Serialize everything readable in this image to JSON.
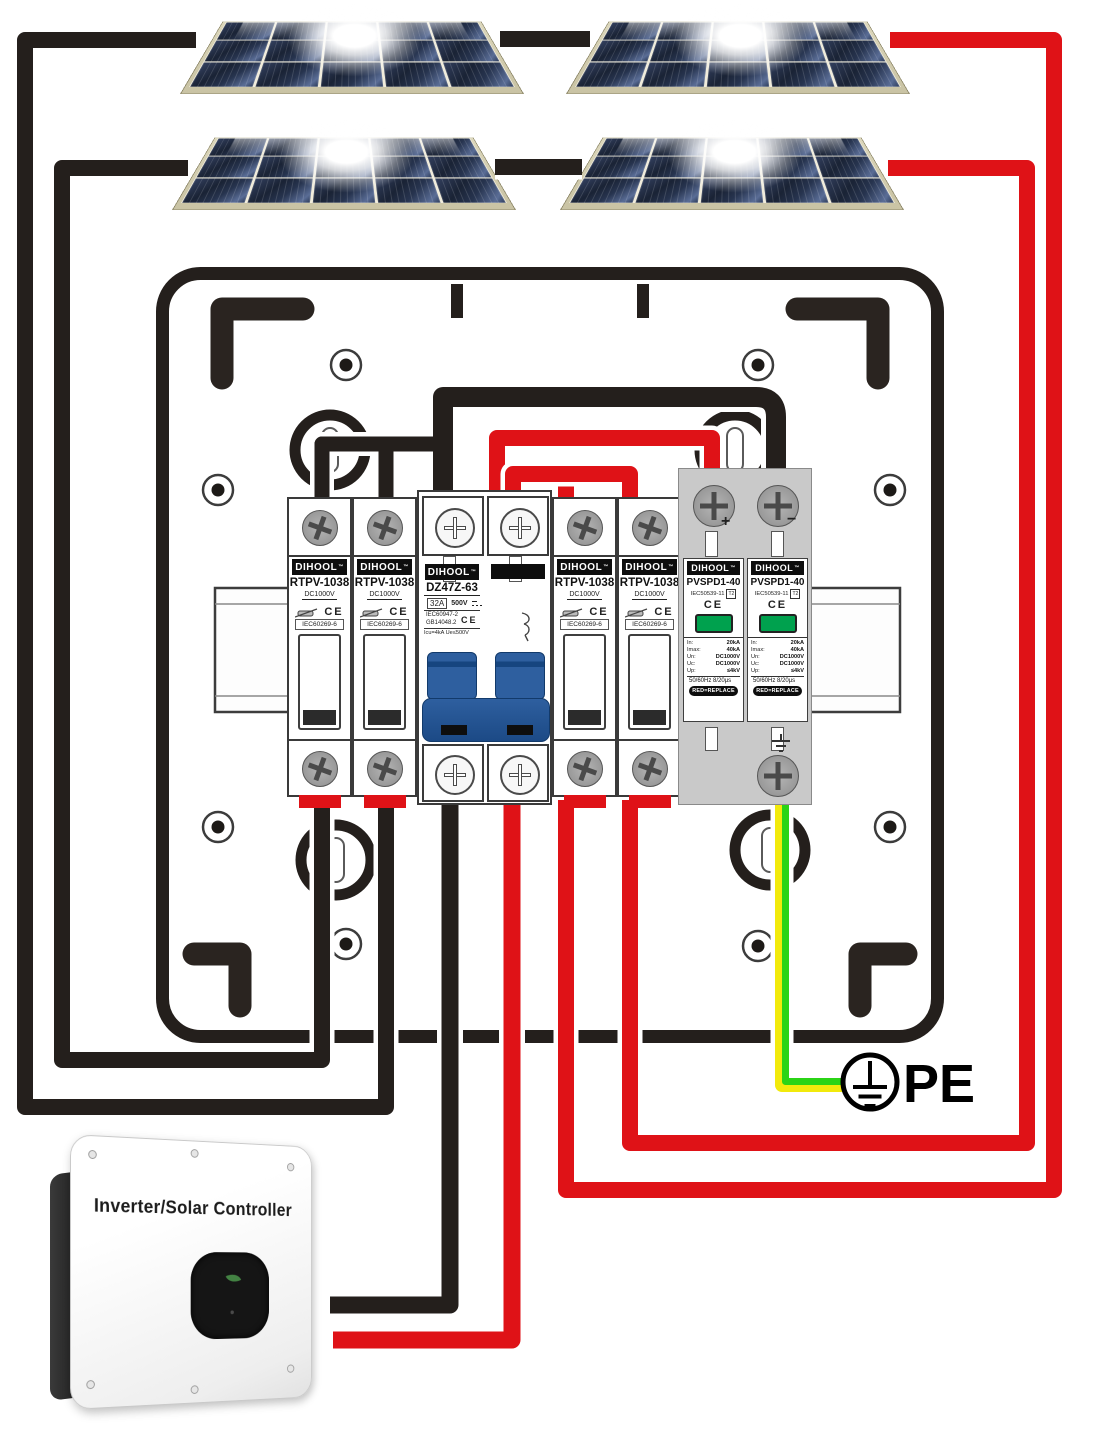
{
  "tm": "™",
  "fuse": {
    "brand": "DIHOOL",
    "model": "RTPV-1038",
    "voltage": "DC1000V",
    "ce": "CE",
    "standard": "IEC60269-6"
  },
  "breaker": {
    "brand": "DIHOOL",
    "model": "DZ47Z-63",
    "current": "32A",
    "voltage": "500V",
    "std1": "IEC60947-2",
    "std2": "GB14048.2",
    "ce": "CE",
    "detail": "Icu=4kA Ue≤500V"
  },
  "spd": {
    "brand": "DIHOOL",
    "model": "PVSPD1-40",
    "standard": "IEC50539-11",
    "tclass": "T2",
    "ce": "CE",
    "plus": "+",
    "minus": "−",
    "specs": [
      {
        "k": "In:",
        "v": "20kA"
      },
      {
        "k": "Imax:",
        "v": "40kA"
      },
      {
        "k": "Un:",
        "v": "DC1000V"
      },
      {
        "k": "Uc:",
        "v": "DC1000V"
      },
      {
        "k": "Up:",
        "v": "≤4kV"
      }
    ],
    "freq": "50/60Hz 8/20μs",
    "replace": "RED=REPLACE"
  },
  "inverter": {
    "title": "Inverter/Solar Controller"
  },
  "pe_label": "PE",
  "icons": [
    "solar-panel",
    "fuse-cartridge-icon",
    "ce-mark",
    "dc-symbol-icon",
    "trip-curve-icon",
    "ground-symbol-icon",
    "pe-earth-icon",
    "leaf-icon",
    "phillips-screw-icon",
    "green-indicator-window"
  ],
  "colors": {
    "box_dark": "#241f1c",
    "wire_black": "#241f1c",
    "wire_red": "#df1217",
    "wire_yellow": "#f2ea0c",
    "wire_green": "#2bd416",
    "toggle_blue": "#2e5f9f",
    "indicator_green": "#00a14e",
    "spd_gray": "#c9c9c9"
  }
}
